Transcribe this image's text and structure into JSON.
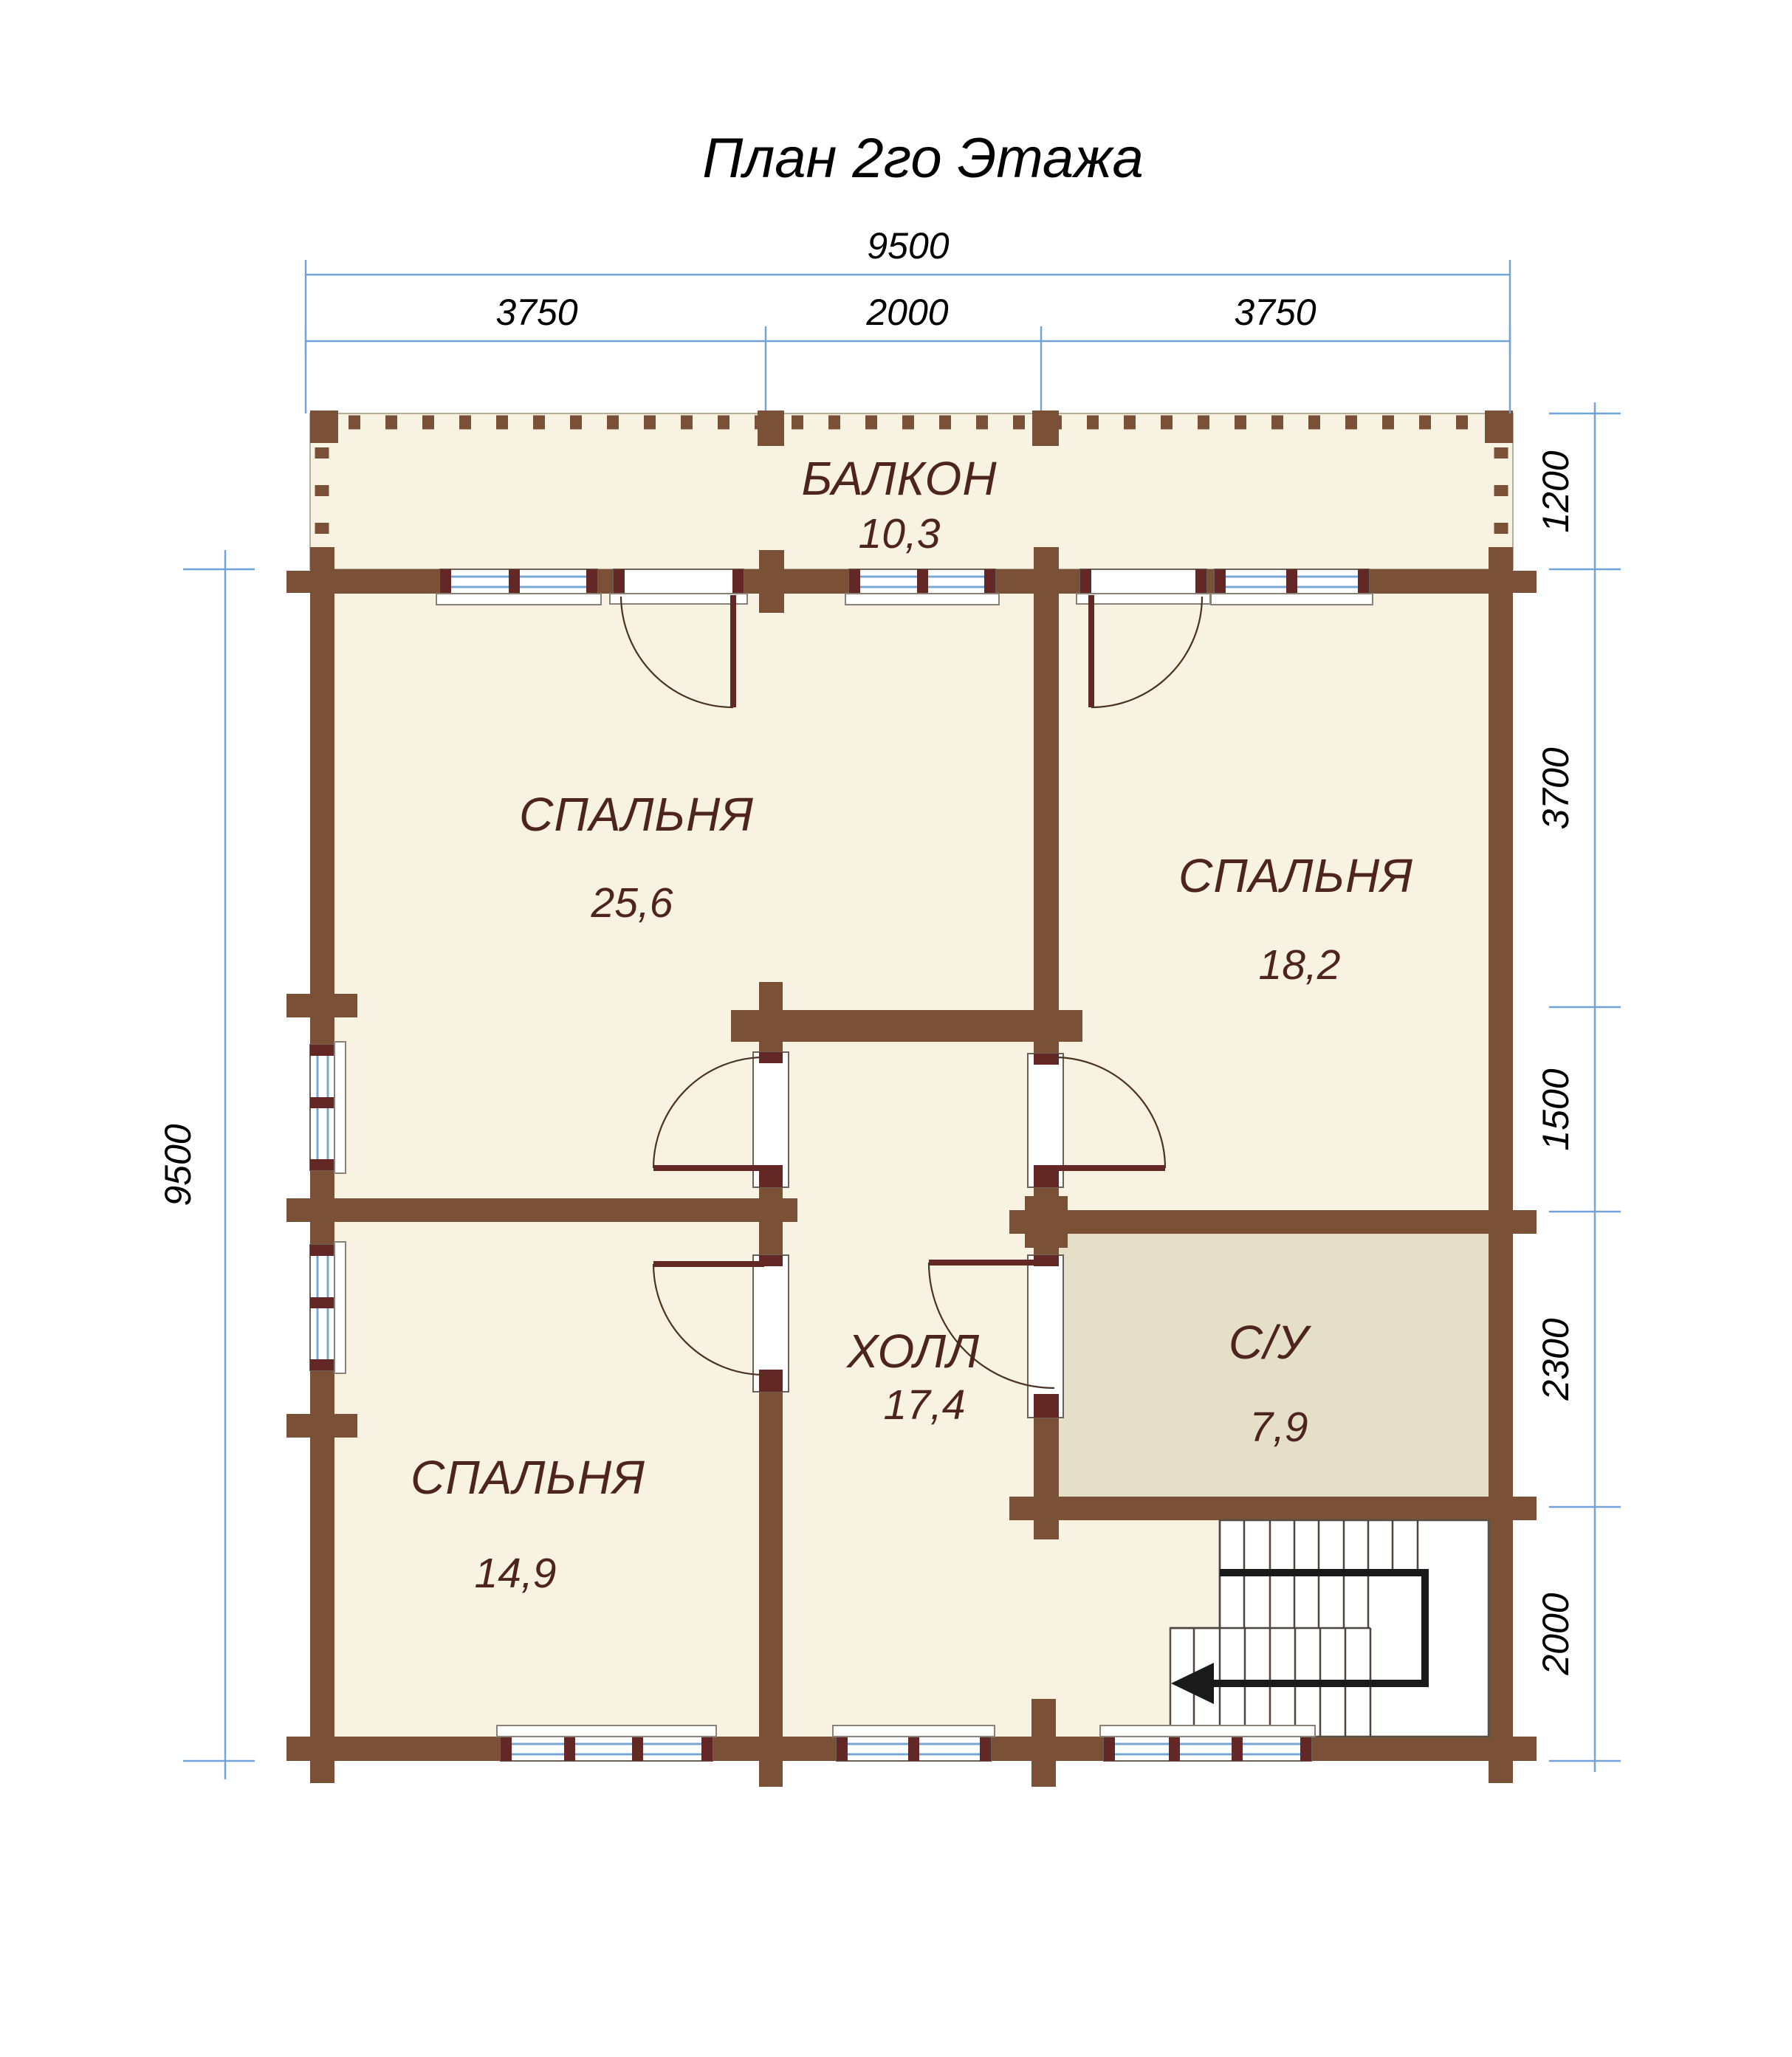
{
  "title": "План 2го Этажа",
  "rooms": [
    {
      "name": "БАЛКОН",
      "area": "10,3"
    },
    {
      "name": "СПАЛЬНЯ",
      "area": "25,6"
    },
    {
      "name": "СПАЛЬНЯ",
      "area": "18,2"
    },
    {
      "name": "СПАЛЬНЯ",
      "area": "14,9"
    },
    {
      "name": "ХОЛЛ",
      "area": "17,4"
    },
    {
      "name": "С/У",
      "area": "7,9"
    }
  ],
  "dimensions": {
    "top_total": "9500",
    "top_segments": [
      "3750",
      "2000",
      "3750"
    ],
    "left_total": "9500",
    "right_segments": [
      "1200",
      "3700",
      "1500",
      "2300",
      "2000"
    ]
  },
  "colors": {
    "wall": "#7a5136",
    "trim": "#632826",
    "room_fill": "#f8f2e3",
    "bathroom_fill": "#e5dfca",
    "label": "#4e241e",
    "dimension_line": "#71a3d8",
    "glazing": "#79a7d4",
    "stair_path": "#1a1a1a"
  }
}
